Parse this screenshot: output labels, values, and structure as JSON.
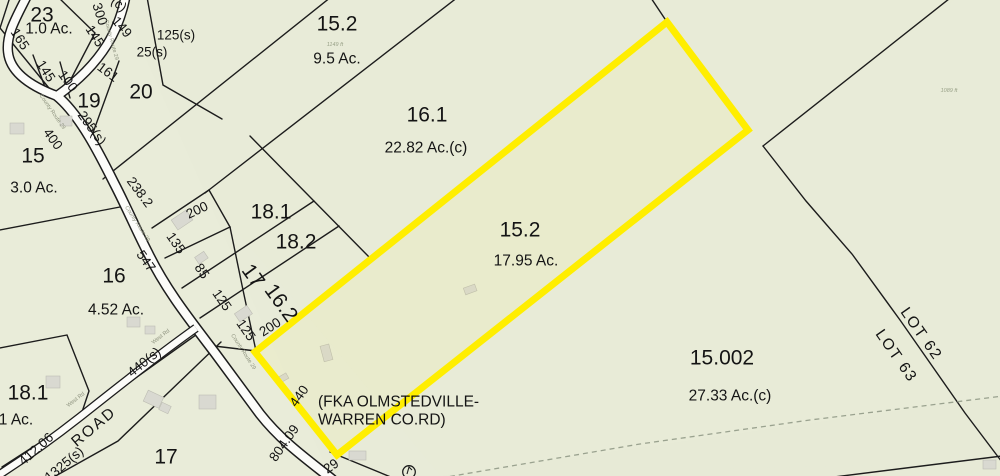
{
  "map": {
    "colors": {
      "background": "#e8ebd8",
      "parcel_line": "#1c1c1c",
      "highlight": "#ffee00",
      "road_fill": "#fcfcf9",
      "building_fill": "#d9d9d1",
      "dashed_line": "#9aa28f",
      "label_ink": "#141414",
      "road_name_ink": "#8d927e"
    },
    "selected_parcel": {
      "id": "15.2",
      "acreage": "17.95 Ac."
    },
    "label_groups": {
      "parcels": [
        {
          "text": "23",
          "x": 42,
          "y": 15,
          "size": 22
        },
        {
          "text": "19",
          "x": 89,
          "y": 101,
          "size": 22
        },
        {
          "text": "20",
          "x": 141,
          "y": 92,
          "size": 22
        },
        {
          "text": "15",
          "x": 33,
          "y": 156,
          "size": 22
        },
        {
          "text": "16",
          "x": 114,
          "y": 276,
          "size": 22
        },
        {
          "text": "18.1",
          "x": 271,
          "y": 212,
          "size": 20
        },
        {
          "text": "18.2",
          "x": 296,
          "y": 242,
          "size": 20
        },
        {
          "text": "15.2",
          "x": 337,
          "y": 24,
          "size": 22
        },
        {
          "text": "16.1",
          "x": 427,
          "y": 115,
          "size": 22
        },
        {
          "text": "15.2",
          "x": 520,
          "y": 230,
          "size": 22
        },
        {
          "text": "15.002",
          "x": 722,
          "y": 358,
          "size": 21
        },
        {
          "text": "18.1",
          "x": 28,
          "y": 393,
          "size": 20
        },
        {
          "text": "17",
          "x": 166,
          "y": 457,
          "size": 20
        },
        {
          "text": "17",
          "x": 253,
          "y": 276,
          "size": 19,
          "rot": 54
        },
        {
          "text": "16.2",
          "x": 281,
          "y": 303,
          "size": 17.5,
          "rot": 54
        }
      ],
      "acreages": [
        {
          "text": "1.0 Ac.",
          "x": 49,
          "y": 29
        },
        {
          "text": "3.0 Ac.",
          "x": 34,
          "y": 188,
          "size": 16
        },
        {
          "text": "4.52 Ac.",
          "x": 116,
          "y": 310,
          "size": 16
        },
        {
          "text": "9.5 Ac.",
          "x": 337,
          "y": 59,
          "size": 17
        },
        {
          "text": "22.82 Ac.(c)",
          "x": 426,
          "y": 148,
          "size": 17
        },
        {
          "text": "17.95 Ac.",
          "x": 526,
          "y": 261,
          "size": 17
        },
        {
          "text": "27.33 Ac.(c)",
          "x": 730,
          "y": 396,
          "size": 17
        },
        {
          "text": "1 Ac.",
          "x": 16,
          "y": 420
        }
      ],
      "dimensions": [
        {
          "text": "165",
          "x": 20,
          "y": 39,
          "rot": 57
        },
        {
          "text": "145",
          "x": 46,
          "y": 71,
          "rot": 57
        },
        {
          "text": "100",
          "x": 68,
          "y": 81,
          "rot": 53
        },
        {
          "text": "161",
          "x": 108,
          "y": 72,
          "rot": 37
        },
        {
          "text": "300",
          "x": 100,
          "y": 14,
          "rot": 72
        },
        {
          "text": "149",
          "x": 122,
          "y": 27,
          "rot": 50
        },
        {
          "text": "145",
          "x": 95,
          "y": 36,
          "rot": 57
        },
        {
          "text": "(c)",
          "x": 119,
          "y": 4,
          "rot": 40
        },
        {
          "text": "125(s)",
          "x": 176,
          "y": 35
        },
        {
          "text": "25(s)",
          "x": 152,
          "y": 52
        },
        {
          "text": "295(s)",
          "x": 92,
          "y": 128,
          "rot": 54
        },
        {
          "text": "400",
          "x": 53,
          "y": 139,
          "rot": 54
        },
        {
          "text": "238.2",
          "x": 140,
          "y": 192,
          "rot": 53
        },
        {
          "text": "200",
          "x": 197,
          "y": 210,
          "rot": -25
        },
        {
          "text": "135",
          "x": 176,
          "y": 243,
          "rot": 55
        },
        {
          "text": "85",
          "x": 202,
          "y": 271,
          "rot": 55
        },
        {
          "text": "547",
          "x": 146,
          "y": 261,
          "rot": 55
        },
        {
          "text": "125",
          "x": 222,
          "y": 300,
          "rot": 55
        },
        {
          "text": "125",
          "x": 246,
          "y": 330,
          "rot": 55
        },
        {
          "text": "200",
          "x": 270,
          "y": 327,
          "rot": -33
        },
        {
          "text": "412.06",
          "x": 36,
          "y": 449,
          "rot": -42
        },
        {
          "text": "440(s)",
          "x": 144,
          "y": 362,
          "rot": -39
        },
        {
          "text": "1325(s)",
          "x": 64,
          "y": 464,
          "rot": -40
        },
        {
          "text": "440",
          "x": 299,
          "y": 396,
          "rot": -55
        },
        {
          "text": "804.09",
          "x": 284,
          "y": 443,
          "rot": -55
        },
        {
          "text": "29",
          "x": 331,
          "y": 466,
          "rot": -35
        }
      ],
      "annotations": [
        {
          "name": "fka-note-line1",
          "text": "(FKA OLMSTEDVILLE-",
          "x": 318,
          "y": 402,
          "anchor": "start"
        },
        {
          "name": "fka-note-line2",
          "text": "WARREN CO.RD)",
          "x": 318,
          "y": 420,
          "anchor": "start"
        },
        {
          "name": "road-right-of-way-label",
          "text": "ROAD",
          "x": 94,
          "y": 427,
          "rot": -40,
          "ls": 2
        },
        {
          "name": "lot-62-label",
          "text": "LOT 62",
          "x": 921,
          "y": 334,
          "rot": 55,
          "size": 21,
          "ls": 1.5
        },
        {
          "name": "lot-63-label",
          "text": "LOT 63",
          "x": 896,
          "y": 356,
          "rot": 55,
          "size": 21,
          "ls": 1.5
        }
      ],
      "road_names": [
        {
          "text": "County Route 29",
          "x": 111,
          "y": 40,
          "rot": 75
        },
        {
          "text": "County Route 29",
          "x": 52,
          "y": 112,
          "rot": 55
        },
        {
          "text": "County Route 29",
          "x": 137,
          "y": 224,
          "rot": 57
        },
        {
          "text": "County Route 29",
          "x": 243,
          "y": 352,
          "rot": 57
        },
        {
          "text": "West Rd",
          "x": 161,
          "y": 337,
          "rot": -38
        },
        {
          "text": "West Rd",
          "x": 76,
          "y": 400,
          "rot": -38
        }
      ],
      "terrain": [
        {
          "text": "1149 ft",
          "x": 335,
          "y": 45
        },
        {
          "text": "1089 ft",
          "x": 949,
          "y": 91
        }
      ]
    }
  }
}
